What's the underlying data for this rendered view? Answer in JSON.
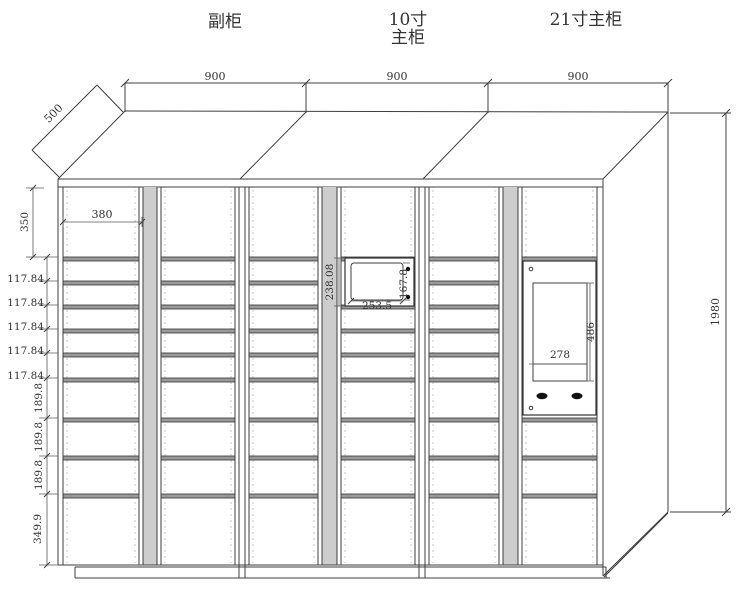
{
  "page": {
    "background": "#ffffff",
    "line_color": "#3f3f3f",
    "accent_red": "#e02a1f"
  },
  "titles": {
    "left_cabinet": "副柜",
    "middle_cabinet_line1": "10寸",
    "middle_cabinet_line2": "主柜",
    "right_cabinet": "21寸主柜"
  },
  "dims": {
    "top_widths": [
      "900",
      "900",
      "900"
    ],
    "depth": "500",
    "top_row_height": "350",
    "door_width": "380",
    "small_rows": [
      "117.84",
      "117.84",
      "117.84",
      "117.84",
      "117.84"
    ],
    "medium_rows": [
      "189.8",
      "189.8",
      "189.8"
    ],
    "bottom_row": "349.9",
    "total_height": "1980",
    "screen10": {
      "panel_height": "238.08",
      "screen_width": "253.5",
      "screen_height": "167.8"
    },
    "screen21": {
      "screen_height": "486",
      "screen_width": "278"
    }
  }
}
